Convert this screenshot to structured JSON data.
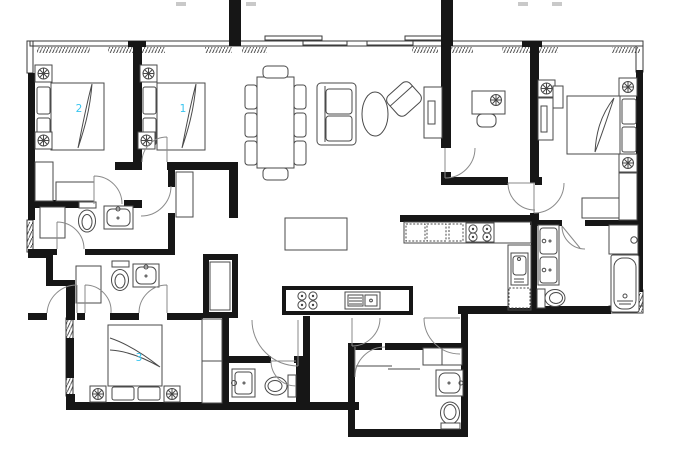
{
  "title": "apartment-floor-plan",
  "colors": {
    "wall": "#161616",
    "line": "#4a4a4a",
    "door": "#8a8a8a",
    "label": "#38c5f0",
    "bg": "#ffffff"
  },
  "bed_labels": {
    "bedroom_1": "1",
    "bedroom_2": "2",
    "bedroom_3": "3"
  },
  "icons": [
    "bed",
    "pillow",
    "lamp",
    "wardrobe",
    "toilet",
    "sink",
    "shower",
    "bathtub",
    "dining-table",
    "chair",
    "sofa",
    "armchair",
    "coffee-table",
    "tv-cabinet",
    "kitchen-island",
    "cooktop",
    "kitchen-sink",
    "desk",
    "door-swing",
    "window",
    "sliding-door",
    "closet-shaft"
  ]
}
